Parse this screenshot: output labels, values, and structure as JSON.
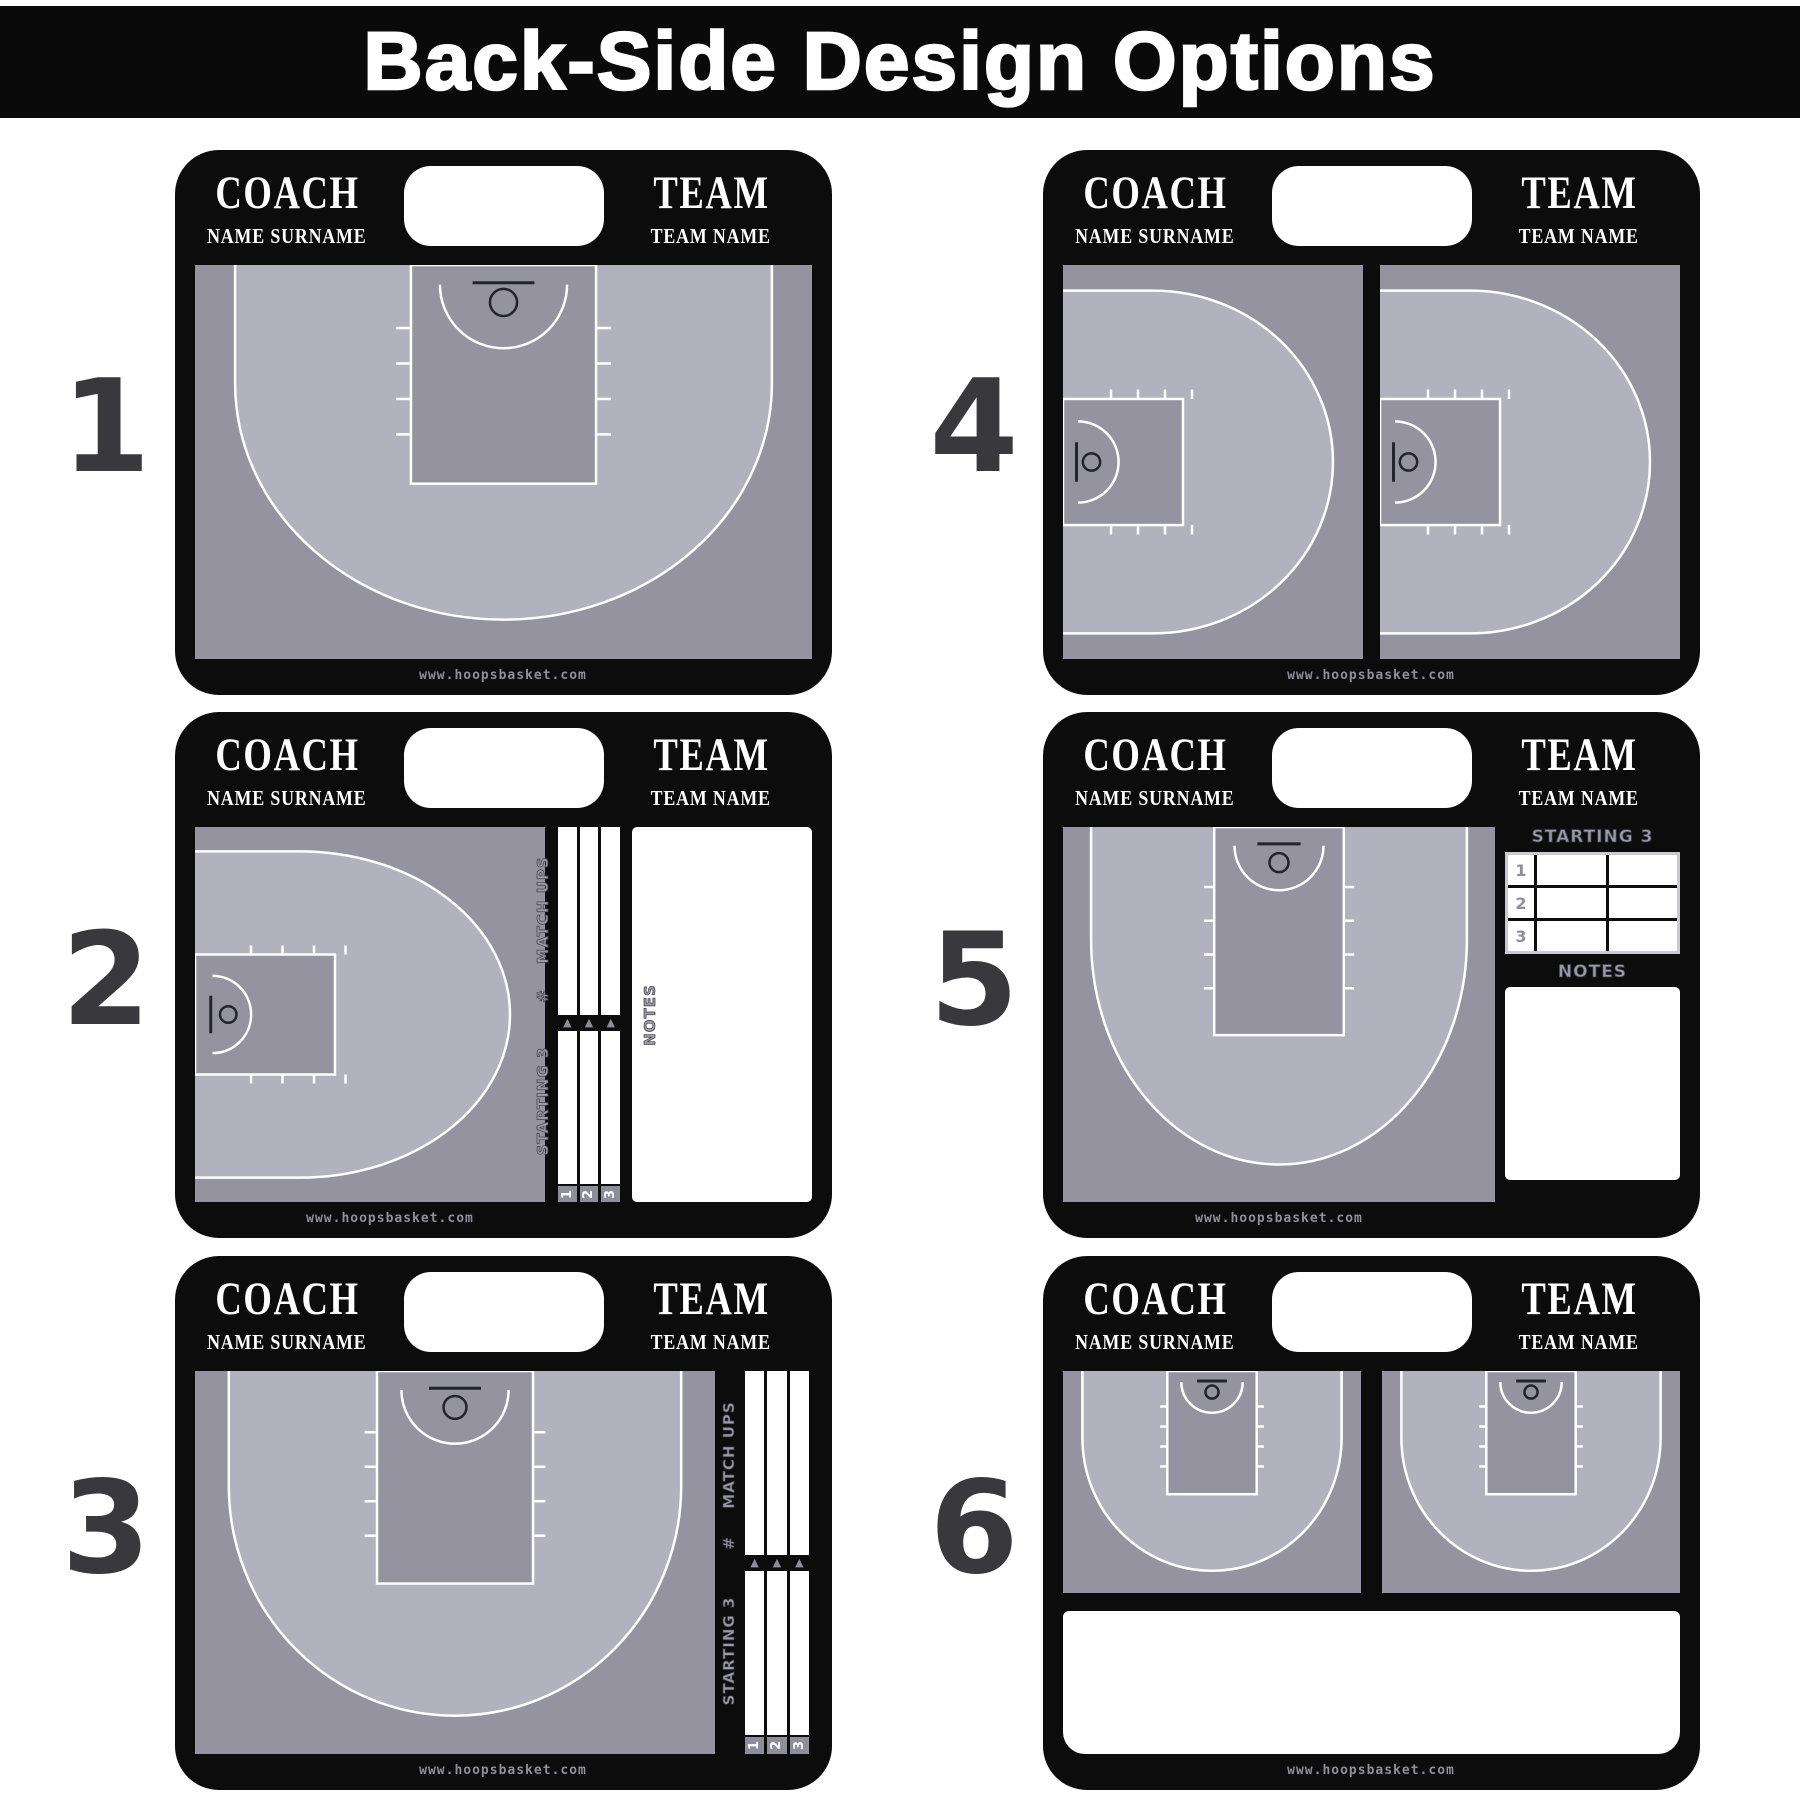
{
  "title": "Back-Side Design Options",
  "colors": {
    "board_black": "#0c0c0c",
    "court_dark": "#94939f",
    "court_light": "#b2b1be",
    "line_white": "#ffffff",
    "accent_gray": "#8e8d9a",
    "ink": "#232331"
  },
  "boards": [
    {
      "number": "1",
      "option": "full-halfcourt",
      "coach_label": "COACH",
      "coach_name": "NAME SURNAME",
      "team_label": "TEAM",
      "team_name": "TEAM NAME",
      "website": "www.hoopsbasket.com"
    },
    {
      "number": "2",
      "option": "side-halfcourt-matchups-notes",
      "coach_label": "COACH",
      "coach_name": "NAME SURNAME",
      "team_label": "TEAM",
      "team_name": "TEAM NAME",
      "matchups_label": "MATCH UPS",
      "number_sign": "#",
      "starting_label": "STARTING 3",
      "notes_label": "NOTES",
      "slots": [
        "1",
        "2",
        "3"
      ],
      "website": "www.hoopsbasket.com"
    },
    {
      "number": "3",
      "option": "halfcourt-matchups-right",
      "coach_label": "COACH",
      "coach_name": "NAME SURNAME",
      "team_label": "TEAM",
      "team_name": "TEAM NAME",
      "matchups_label": "MATCH UPS",
      "number_sign": "#",
      "starting_label": "STARTING 3",
      "slots": [
        "1",
        "2",
        "3"
      ],
      "website": "www.hoopsbasket.com"
    },
    {
      "number": "4",
      "option": "two-side-halfcourts",
      "coach_label": "COACH",
      "coach_name": "NAME SURNAME",
      "team_label": "TEAM",
      "team_name": "TEAM NAME",
      "website": "www.hoopsbasket.com"
    },
    {
      "number": "5",
      "option": "halfcourt-starting3-notes",
      "coach_label": "COACH",
      "coach_name": "NAME SURNAME",
      "team_label": "TEAM",
      "team_name": "TEAM NAME",
      "starting_label": "STARTING 3",
      "notes_label": "NOTES",
      "rows": [
        "1",
        "2",
        "3"
      ],
      "website": "www.hoopsbasket.com"
    },
    {
      "number": "6",
      "option": "two-halfcourts-notes",
      "coach_label": "COACH",
      "coach_name": "NAME SURNAME",
      "team_label": "TEAM",
      "team_name": "TEAM NAME",
      "website": "www.hoopsbasket.com"
    }
  ]
}
